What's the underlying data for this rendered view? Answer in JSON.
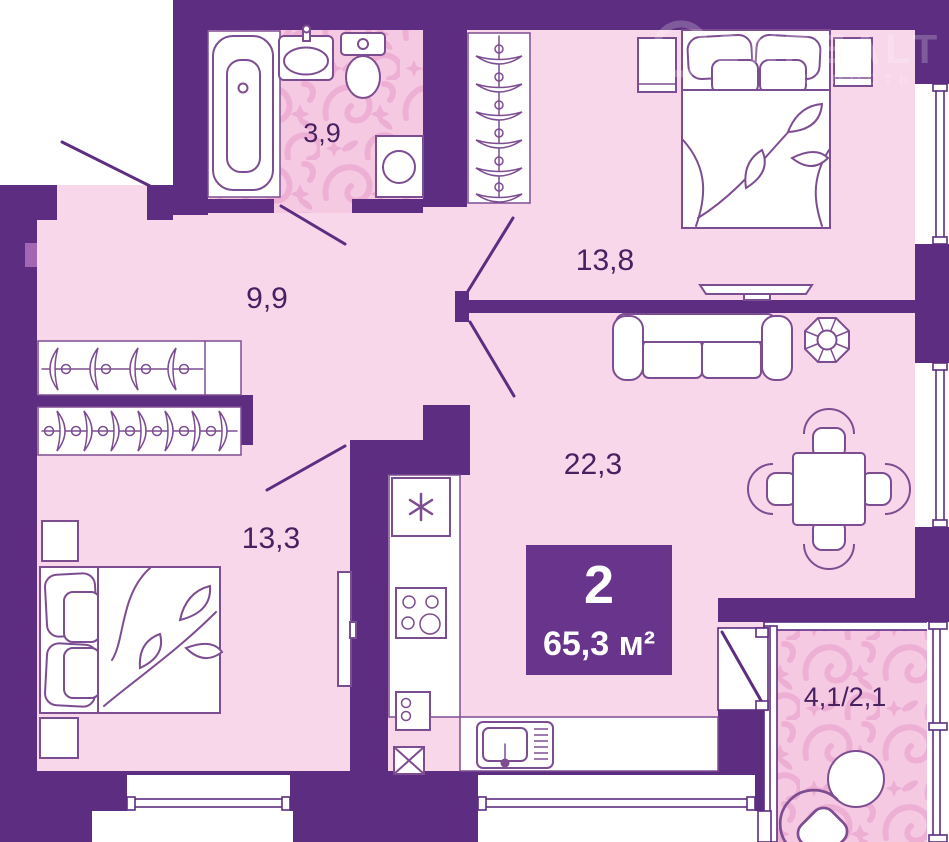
{
  "colors": {
    "wall": "#5c2d80",
    "wall-light": "#a266b4",
    "badge-bg": "#68348c",
    "badge-text": "#ffffff",
    "floor": "#f8d7ea",
    "pattern-bg": "#f5c9e2",
    "swirl": "#ecabd3",
    "line": "#7d4d92",
    "label": "#472160",
    "watermark": "#ffffff"
  },
  "badge": {
    "rooms": "2",
    "area": "65,3 м²"
  },
  "rooms": {
    "bathroom": {
      "label": "3,9"
    },
    "hallway": {
      "label": "9,9"
    },
    "bedroom_top": {
      "label": "13,8"
    },
    "living": {
      "label": "22,3"
    },
    "bedroom_left": {
      "label": "13,3"
    },
    "balcony": {
      "label": "4,1/2,1"
    }
  },
  "watermark": {
    "brand": "ONREALT",
    "tagline": "НЕДВИЖИМОСТЬ"
  }
}
